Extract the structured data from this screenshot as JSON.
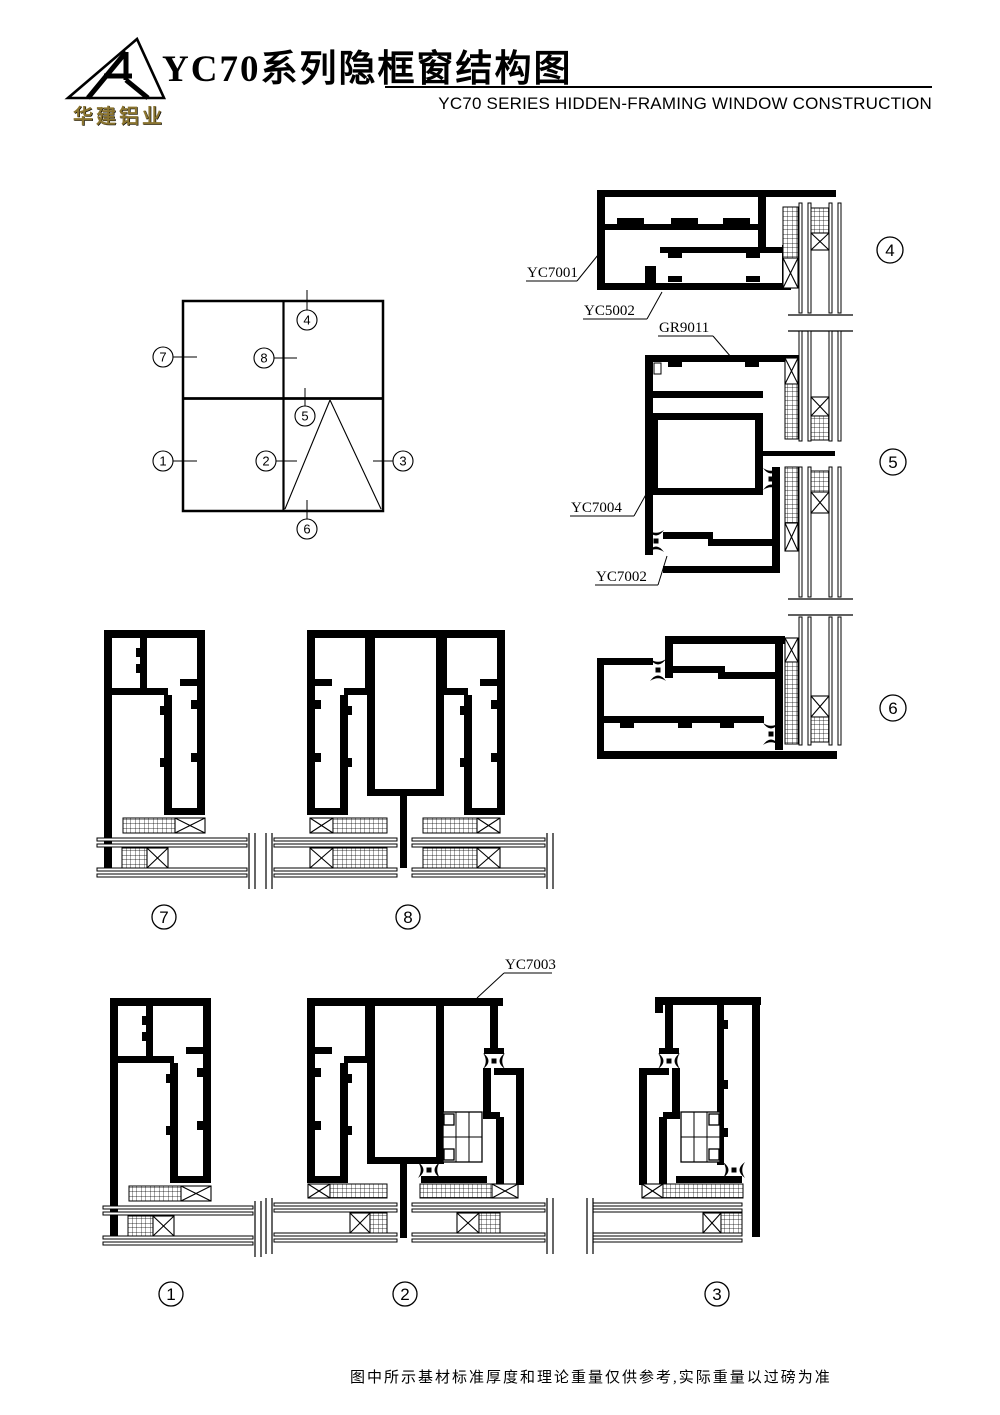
{
  "header": {
    "brand_text": "华建铝业",
    "title": "YC70系列隐框窗结构图",
    "subtitle": "YC70 SERIES HIDDEN-FRAMING WINDOW CONSTRUCTION"
  },
  "schematic": {
    "callouts": {
      "c1": "1",
      "c2": "2",
      "c3": "3",
      "c4": "4",
      "c5": "5",
      "c6": "6",
      "c7": "7",
      "c8": "8"
    }
  },
  "details": {
    "badges": {
      "d1": "1",
      "d2": "2",
      "d3": "3",
      "d4": "4",
      "d5": "5",
      "d6": "6",
      "d7": "7",
      "d8": "8"
    }
  },
  "part_labels": {
    "yc7001": "YC7001",
    "yc5002": "YC5002",
    "gr9011": "GR9011",
    "yc7004": "YC7004",
    "yc7002": "YC7002",
    "yc7003": "YC7003"
  },
  "footer": {
    "note": "图中所示基材标准厚度和理论重量仅供参考,实际重量以过磅为准"
  },
  "colors": {
    "ink": "#000000",
    "brand_gold": "#8a7430",
    "paper": "#ffffff"
  }
}
